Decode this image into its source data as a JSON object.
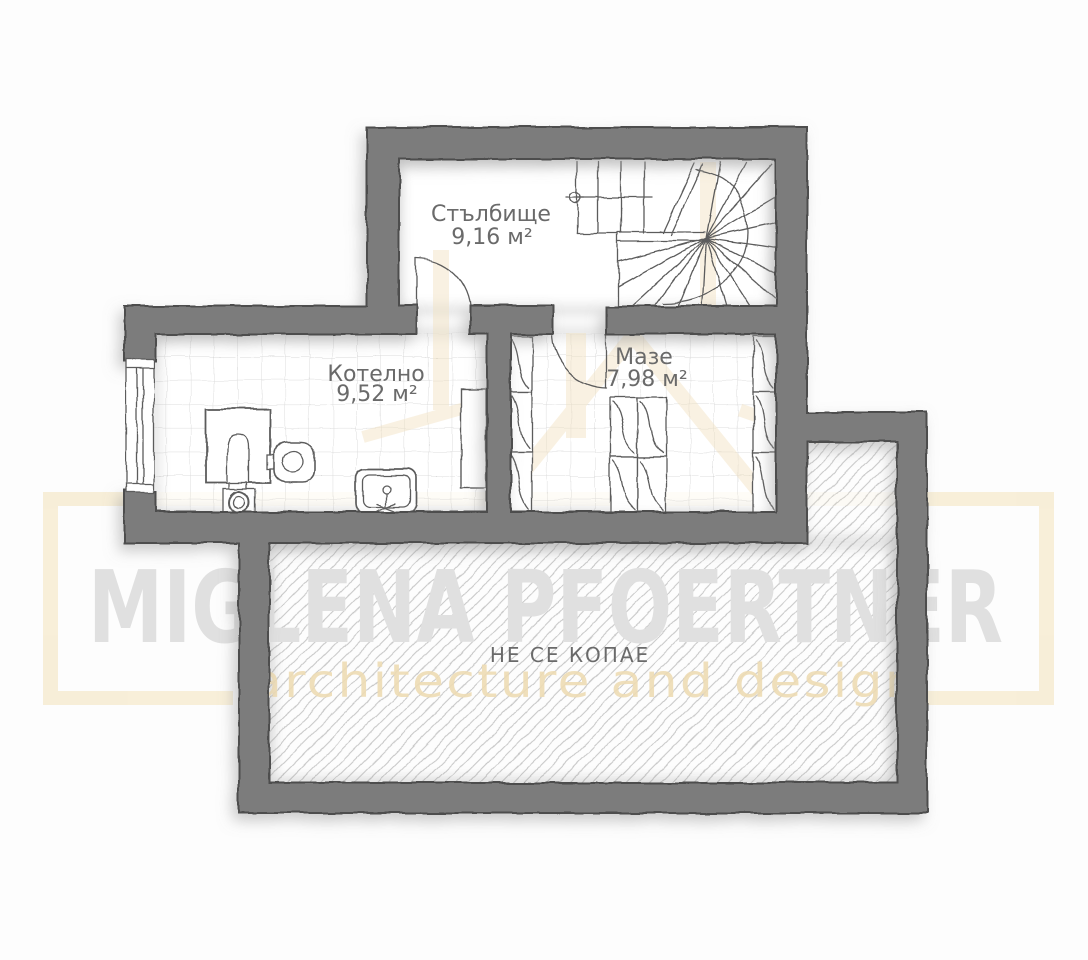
{
  "plan": {
    "rooms": [
      {
        "name": "Стълбище",
        "area": "9,16 м²"
      },
      {
        "name": "Котелно",
        "area": "9,52 м²"
      },
      {
        "name": "Мазе",
        "area": "7,98 м²"
      }
    ],
    "no_dig_label": "НЕ СЕ КОПАЕ"
  },
  "watermark": {
    "name": "MIGLENA PFOERTNER",
    "tagline": "architecture and design"
  },
  "colors": {
    "wall": "#7b7b7b",
    "wall_outline": "#4d4d4d",
    "tile_line": "#dcdcdc",
    "hatch_line": "#c9c9c9",
    "label": "#6a6a6a",
    "watermark_gray": "#e0e0e0",
    "watermark_tan": "#eedcb4",
    "frame_tan": "#f7ecd2",
    "streak_tan": "#f2e1bf"
  }
}
